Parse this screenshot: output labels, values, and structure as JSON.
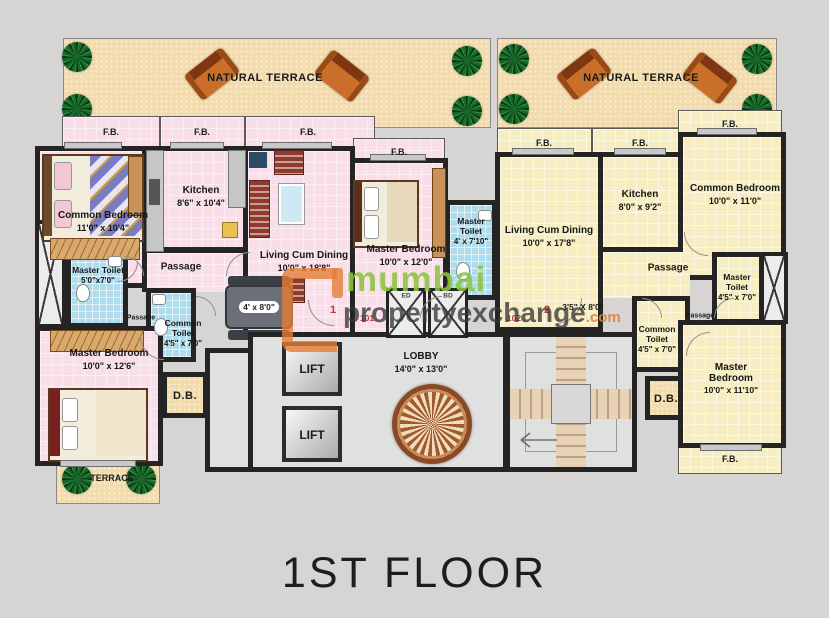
{
  "title": "1ST FLOOR",
  "labels": {
    "fb": "F.B.",
    "passage": "Passage",
    "db": "D.B.",
    "lift": "LIFT",
    "natural_terrace": "NATURAL TERRACE",
    "terrace": "TERRACE"
  },
  "lobby": {
    "name": "LOBBY",
    "dims": "14'0\" x 13'0\""
  },
  "ducts": {
    "left": "ED",
    "right": "BD"
  },
  "door_numbers": {
    "flat1_door": "1",
    "flat1": "101",
    "flat2": "102",
    "flat2_door": "2"
  },
  "flat101": {
    "common_bedroom": {
      "name": "Common Bedroom",
      "dims": "11'0\" x 10'4\""
    },
    "kitchen": {
      "name": "Kitchen",
      "dims": "8'6\" x 10'4\""
    },
    "living": {
      "name": "Living Cum Dining",
      "dims": "10'0\" x 18'8\""
    },
    "dining_table": "4' x 8'0\"",
    "master_bedroom": {
      "name": "Master Bedroom",
      "dims": "10'0\" x 12'0\""
    },
    "master_toilet_a": {
      "name": "Master Toilet",
      "dims": "4' x 7'10\""
    },
    "master_toilet_b": {
      "name": "Master Toilet",
      "dims": "5'0\"x7'0\""
    },
    "common_toilet": {
      "name": "Common Toilet",
      "dims": "4'5\" x 7'0\""
    },
    "master_bedroom2": {
      "name": "Master Bedroom",
      "dims": "10'0\" x 12'6\""
    }
  },
  "flat102": {
    "living": {
      "name": "Living Cum Dining",
      "dims": "10'0\" x 17'8\""
    },
    "passage_dims": "3'5\" X 8'0\"",
    "kitchen": {
      "name": "Kitchen",
      "dims": "8'0\" x 9'2\""
    },
    "common_bedroom": {
      "name": "Common Bedroom",
      "dims": "10'0\" x 11'0\""
    },
    "master_toilet": {
      "name": "Master Toilet",
      "dims": "4'5\" x 7'0\""
    },
    "common_toilet": {
      "name": "Common Toilet",
      "dims": "4'5\" x 7'0\""
    },
    "master_bedroom": {
      "name": "Master Bedroom",
      "dims": "10'0\" x 11'10\""
    }
  },
  "watermark": {
    "line1": "mumbai",
    "line2": "propertyexchange",
    "suffix": ".com"
  },
  "colors": {
    "flat101_floor": "#f8dee9",
    "flat102_floor": "#f6eec2",
    "terrace": "#f2dcae",
    "wall": "#242424",
    "toilet_tile": "#aedcec",
    "brand_green": "#8bc43e",
    "brand_orange": "#e47e36",
    "door_number_red": "#c43a35"
  }
}
